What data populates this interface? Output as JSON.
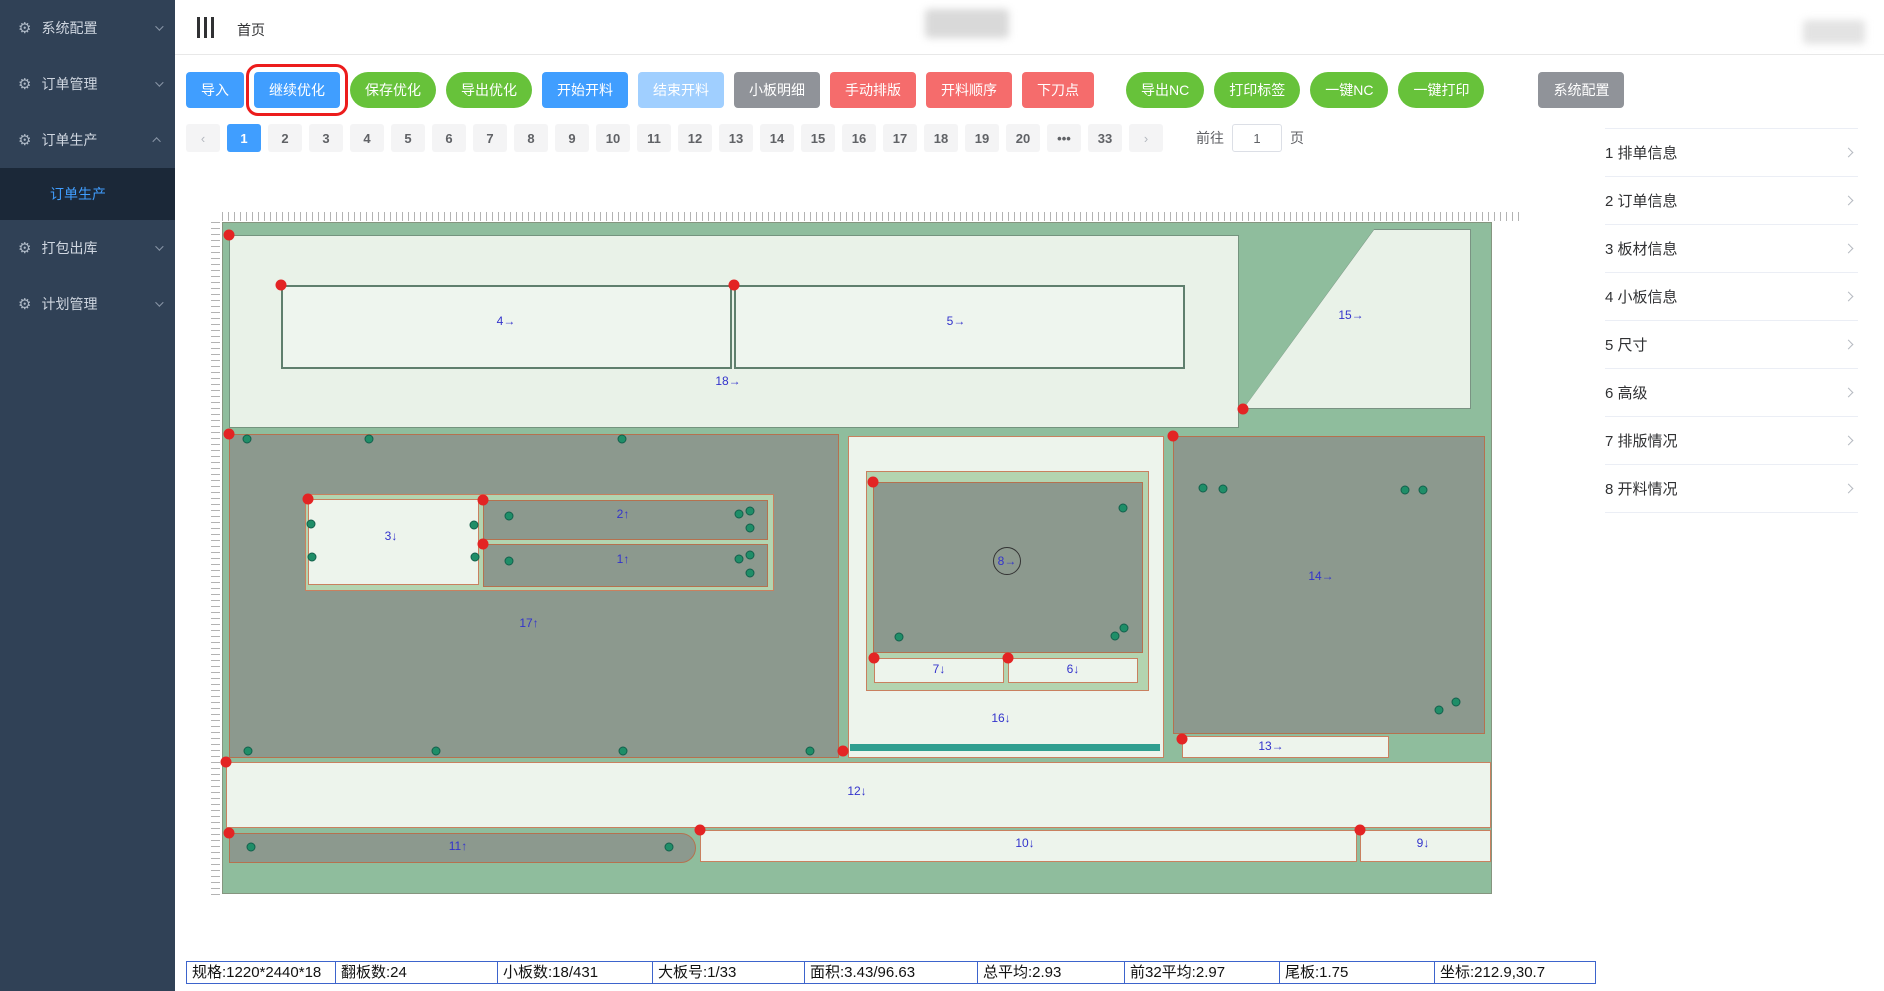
{
  "sidebar": {
    "items": [
      {
        "label": "系统配置",
        "chevron": "down"
      },
      {
        "label": "订单管理",
        "chevron": "down"
      },
      {
        "label": "订单生产",
        "chevron": "up",
        "children": [
          {
            "label": "订单生产",
            "active": true
          }
        ]
      },
      {
        "label": "打包出库",
        "chevron": "down"
      },
      {
        "label": "计划管理",
        "chevron": "down"
      }
    ]
  },
  "header": {
    "breadcrumb": "首页"
  },
  "toolbar": {
    "buttons": [
      {
        "label": "导入",
        "style": "blue",
        "shape": "rect"
      },
      {
        "label": "继续优化",
        "style": "blue",
        "shape": "rect",
        "highlight": true
      },
      {
        "label": "保存优化",
        "style": "green",
        "shape": "pill"
      },
      {
        "label": "导出优化",
        "style": "green",
        "shape": "pill"
      },
      {
        "label": "开始开料",
        "style": "blue",
        "shape": "rect"
      },
      {
        "label": "结束开料",
        "style": "blue-dis",
        "shape": "rect"
      },
      {
        "label": "小板明细",
        "style": "gray",
        "shape": "rect"
      },
      {
        "label": "手动排版",
        "style": "red",
        "shape": "rect"
      },
      {
        "label": "开料顺序",
        "style": "red",
        "shape": "rect"
      },
      {
        "label": "下刀点",
        "style": "red",
        "shape": "rect"
      },
      {
        "label": "导出NC",
        "style": "green",
        "shape": "pill",
        "gap": "lg"
      },
      {
        "label": "打印标签",
        "style": "green",
        "shape": "pill"
      },
      {
        "label": "一键NC",
        "style": "green",
        "shape": "pill"
      },
      {
        "label": "一键打印",
        "style": "green",
        "shape": "pill"
      },
      {
        "label": "系统配置",
        "style": "gray",
        "shape": "rect",
        "gap": "xl"
      }
    ]
  },
  "pagination": {
    "prev": "‹",
    "next": "›",
    "ellipsis": "•••",
    "pages": [
      "1",
      "2",
      "3",
      "4",
      "5",
      "6",
      "7",
      "8",
      "9",
      "10",
      "11",
      "12",
      "13",
      "14",
      "15",
      "16",
      "17",
      "18",
      "19",
      "20"
    ],
    "active": "1",
    "last_page": "33",
    "jump_label": "前往",
    "jump_value": "1",
    "jump_suffix": "页"
  },
  "right_panel": {
    "items": [
      {
        "label": "1 排单信息"
      },
      {
        "label": "2 订单信息"
      },
      {
        "label": "3 板材信息"
      },
      {
        "label": "4 小板信息"
      },
      {
        "label": "5 尺寸"
      },
      {
        "label": "6 高级"
      },
      {
        "label": "7 排版情况"
      },
      {
        "label": "8 开料情况"
      }
    ]
  },
  "status_bar": {
    "cells": [
      {
        "text": "规格:1220*2440*18",
        "w": 150
      },
      {
        "text": "翻板数:24",
        "w": 163
      },
      {
        "text": "小板数:18/431",
        "w": 156
      },
      {
        "text": "大板号:1/33",
        "w": 153
      },
      {
        "text": "面积:3.43/96.63",
        "w": 174
      },
      {
        "text": "总平均:2.93",
        "w": 148
      },
      {
        "text": "前32平均:2.97",
        "w": 156
      },
      {
        "text": "尾板:1.75",
        "w": 156
      },
      {
        "text": "坐标:212.9,30.7",
        "w": 162
      }
    ]
  },
  "canvas": {
    "pieces": [
      {
        "name": "region-18",
        "label": "18→",
        "x": 6,
        "y": 12,
        "w": 1010,
        "h": 193,
        "kind": "lightg",
        "lx": 505,
        "ly": 158
      },
      {
        "name": "panel-4",
        "label": "4→",
        "x": 58,
        "y": 62,
        "w": 451,
        "h": 84,
        "kind": "lightd",
        "lx": 283,
        "ly": 98
      },
      {
        "name": "panel-5",
        "label": "5→",
        "x": 511,
        "y": 62,
        "w": 451,
        "h": 84,
        "kind": "lightd",
        "lx": 733,
        "ly": 98
      },
      {
        "name": "piece-15",
        "label": "15→",
        "x": 1020,
        "y": 6,
        "w": 228,
        "h": 180,
        "kind": "trap",
        "lx": 1128,
        "ly": 92
      },
      {
        "name": "piece-17",
        "label": "17↑",
        "x": 6,
        "y": 211,
        "w": 610,
        "h": 324,
        "kind": "gray",
        "lx": 306,
        "ly": 400
      },
      {
        "name": "band-321",
        "label": null,
        "x": 82,
        "y": 271,
        "w": 469,
        "h": 97,
        "kind": "band"
      },
      {
        "name": "piece-3",
        "label": "3↓",
        "x": 85,
        "y": 276,
        "w": 171,
        "h": 86,
        "kind": "light",
        "lx": 168,
        "ly": 313
      },
      {
        "name": "piece-2",
        "label": "2↑",
        "x": 260,
        "y": 277,
        "w": 285,
        "h": 40,
        "kind": "gray",
        "lx": 400,
        "ly": 291
      },
      {
        "name": "piece-1",
        "label": "1↑",
        "x": 260,
        "y": 321,
        "w": 285,
        "h": 43,
        "kind": "gray",
        "lx": 400,
        "ly": 336
      },
      {
        "name": "region-16",
        "label": "16↓",
        "x": 625,
        "y": 213,
        "w": 316,
        "h": 322,
        "kind": "light",
        "lx": 778,
        "ly": 495
      },
      {
        "name": "band-876",
        "label": null,
        "x": 643,
        "y": 248,
        "w": 283,
        "h": 220,
        "kind": "band"
      },
      {
        "name": "piece-8",
        "label": "8→",
        "x": 650,
        "y": 259,
        "w": 270,
        "h": 171,
        "kind": "gray",
        "lx": 784,
        "ly": 338,
        "circled": true
      },
      {
        "name": "piece-7",
        "label": "7↓",
        "x": 651,
        "y": 435,
        "w": 130,
        "h": 25,
        "kind": "light",
        "lx": 716,
        "ly": 446
      },
      {
        "name": "piece-6",
        "label": "6↓",
        "x": 785,
        "y": 435,
        "w": 130,
        "h": 25,
        "kind": "light",
        "lx": 850,
        "ly": 446
      },
      {
        "name": "piece-14",
        "label": "14→",
        "x": 950,
        "y": 213,
        "w": 312,
        "h": 298,
        "kind": "gray",
        "lx": 1098,
        "ly": 353
      },
      {
        "name": "piece-13",
        "label": "13→",
        "x": 959,
        "y": 513,
        "w": 207,
        "h": 22,
        "kind": "light",
        "lx": 1048,
        "ly": 523
      },
      {
        "name": "piece-12",
        "label": "12↓",
        "x": 3,
        "y": 539,
        "w": 1265,
        "h": 66,
        "kind": "light",
        "lx": 634,
        "ly": 568
      },
      {
        "name": "piece-11",
        "label": "11↑",
        "x": 6,
        "y": 610,
        "w": 467,
        "h": 30,
        "kind": "gray",
        "rounded": true,
        "lx": 235,
        "ly": 623
      },
      {
        "name": "piece-10",
        "label": "10↓",
        "x": 477,
        "y": 607,
        "w": 657,
        "h": 32,
        "kind": "light",
        "lx": 802,
        "ly": 620
      },
      {
        "name": "piece-9",
        "label": "9↓",
        "x": 1137,
        "y": 607,
        "w": 131,
        "h": 32,
        "kind": "light",
        "lx": 1200,
        "ly": 620
      }
    ],
    "teal_bar": {
      "x": 627,
      "y": 521,
      "w": 310,
      "h": 7
    },
    "green_dots": [
      [
        24,
        216
      ],
      [
        146,
        216
      ],
      [
        399,
        216
      ],
      [
        25,
        528
      ],
      [
        213,
        528
      ],
      [
        400,
        528
      ],
      [
        587,
        528
      ],
      [
        88,
        301
      ],
      [
        251,
        302
      ],
      [
        89,
        334
      ],
      [
        252,
        334
      ],
      [
        286,
        293
      ],
      [
        516,
        291
      ],
      [
        527,
        288
      ],
      [
        527,
        305
      ],
      [
        286,
        338
      ],
      [
        516,
        336
      ],
      [
        527,
        332
      ],
      [
        527,
        350
      ],
      [
        900,
        285
      ],
      [
        676,
        414
      ],
      [
        892,
        413
      ],
      [
        901,
        405
      ],
      [
        980,
        265
      ],
      [
        1000,
        266
      ],
      [
        1182,
        267
      ],
      [
        1200,
        267
      ],
      [
        1216,
        487
      ],
      [
        1233,
        479
      ],
      [
        28,
        624
      ],
      [
        446,
        624
      ]
    ],
    "red_dots": [
      [
        6,
        12
      ],
      [
        58,
        62
      ],
      [
        511,
        62
      ],
      [
        1020,
        186
      ],
      [
        6,
        211
      ],
      [
        85,
        276
      ],
      [
        260,
        277
      ],
      [
        260,
        321
      ],
      [
        650,
        259
      ],
      [
        651,
        435
      ],
      [
        785,
        435
      ],
      [
        620,
        528
      ],
      [
        950,
        213
      ],
      [
        959,
        516
      ],
      [
        3,
        539
      ],
      [
        6,
        610
      ],
      [
        477,
        607
      ],
      [
        1137,
        607
      ]
    ]
  }
}
